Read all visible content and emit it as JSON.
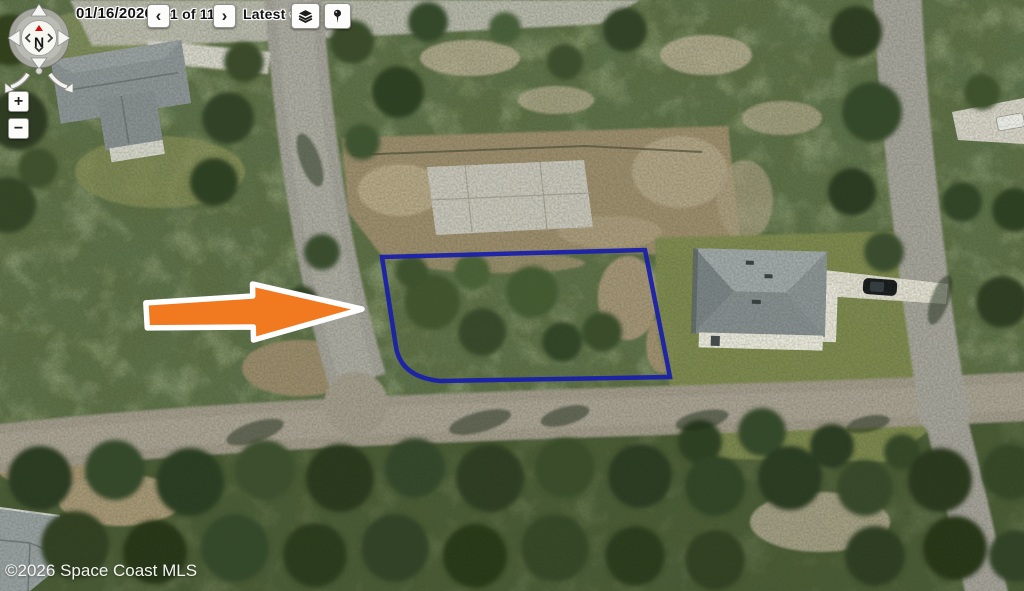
{
  "toolbar": {
    "date": "01/16/2026",
    "prev": "‹",
    "counter": "1 of 11",
    "next": "›",
    "latest": "Latest",
    "caret": "▼",
    "pdf": "PDF"
  },
  "compass": {
    "north": "N"
  },
  "zoom_controls": {
    "zoom_in": "+",
    "zoom_out": "−"
  },
  "map": {
    "copyright": "©2026 Space Coast MLS",
    "colors": {
      "parcel_outline": "#1b21a8",
      "arrow_fill": "#f1791f"
    }
  }
}
